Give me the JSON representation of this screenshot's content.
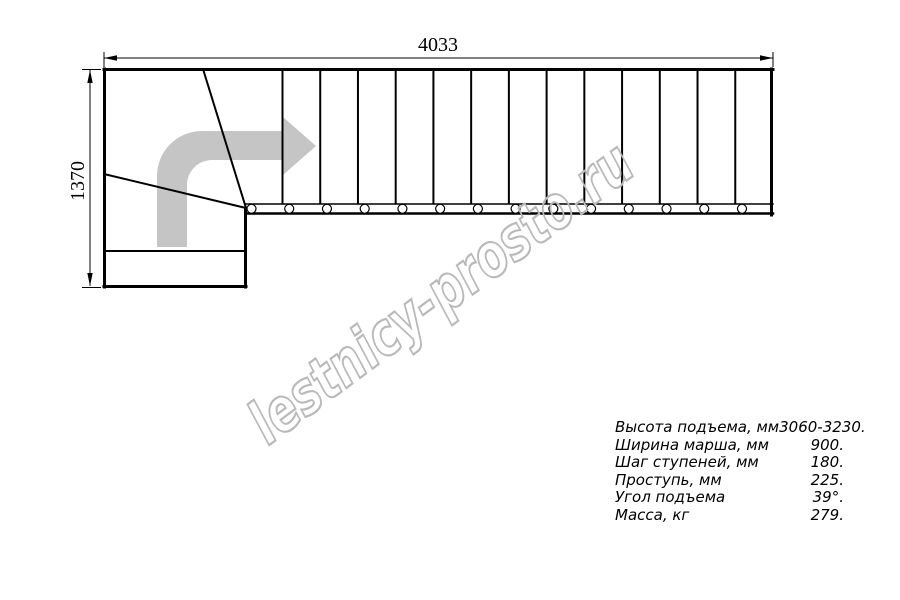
{
  "drawing": {
    "length_label": "4033",
    "width_label": "1370",
    "flight_divider_count": 13,
    "bolt_count": 14,
    "line_color": "#000000",
    "arrow_color": "#c5c5c5"
  },
  "watermark": {
    "text": "lestnicy-prosto.ru",
    "color": "#b9b9b9"
  },
  "specs": {
    "rows": [
      {
        "label": "Высота подъема, мм",
        "value": "3060-3230."
      },
      {
        "label": "Ширина марша, мм",
        "value": "900."
      },
      {
        "label": "Шаг ступеней, мм",
        "value": "180."
      },
      {
        "label": "Проступь, мм",
        "value": "225."
      },
      {
        "label": "Угол подъема",
        "value": "39°."
      },
      {
        "label": "Масса, кг",
        "value": "279."
      }
    ]
  }
}
